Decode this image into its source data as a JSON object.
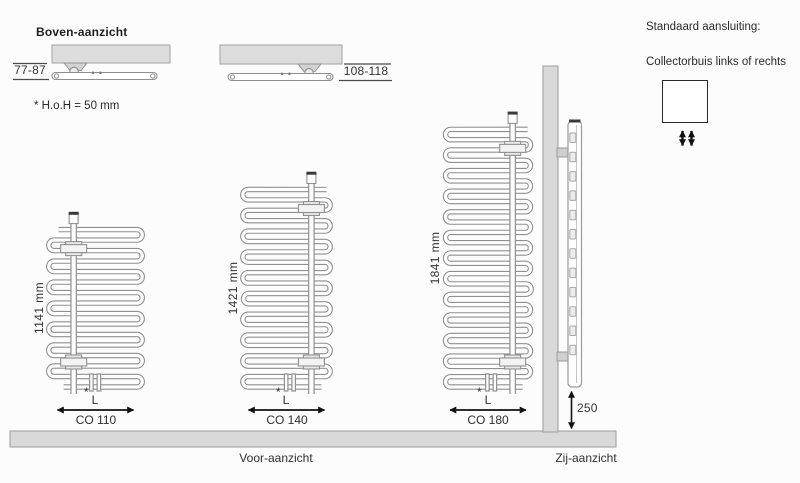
{
  "top_view": {
    "title": "Boven-aanzicht",
    "dim_left": "77-87",
    "dim_right": "108-118",
    "note": "* H.o.H = 50 mm"
  },
  "front_view": {
    "caption": "Voor-aanzicht",
    "width_label": "L",
    "footnote_mark": "*",
    "radiators": [
      {
        "model": "CO 110",
        "height_label": "1141 mm",
        "height_mm": 1141,
        "collector_side": "left"
      },
      {
        "model": "CO 140",
        "height_label": "1421 mm",
        "height_mm": 1421,
        "collector_side": "right"
      },
      {
        "model": "CO 180",
        "height_label": "1841 mm",
        "height_mm": 1841,
        "collector_side": "right"
      }
    ]
  },
  "side_view": {
    "caption": "Zij-aanzicht",
    "bottom_clearance": "250"
  },
  "connection": {
    "title": "Standaard aansluiting:",
    "subtitle": "Collectorbuis links of rechts"
  },
  "colors": {
    "background": "#fcfcfc",
    "panel_fill": "#d9d9d9",
    "panel_outline": "#a3a3a3",
    "tube_outline": "#8f8f8f",
    "text": "#2e2e2e",
    "arrow": "#111111",
    "cap_dark": "#3a3a3a"
  }
}
